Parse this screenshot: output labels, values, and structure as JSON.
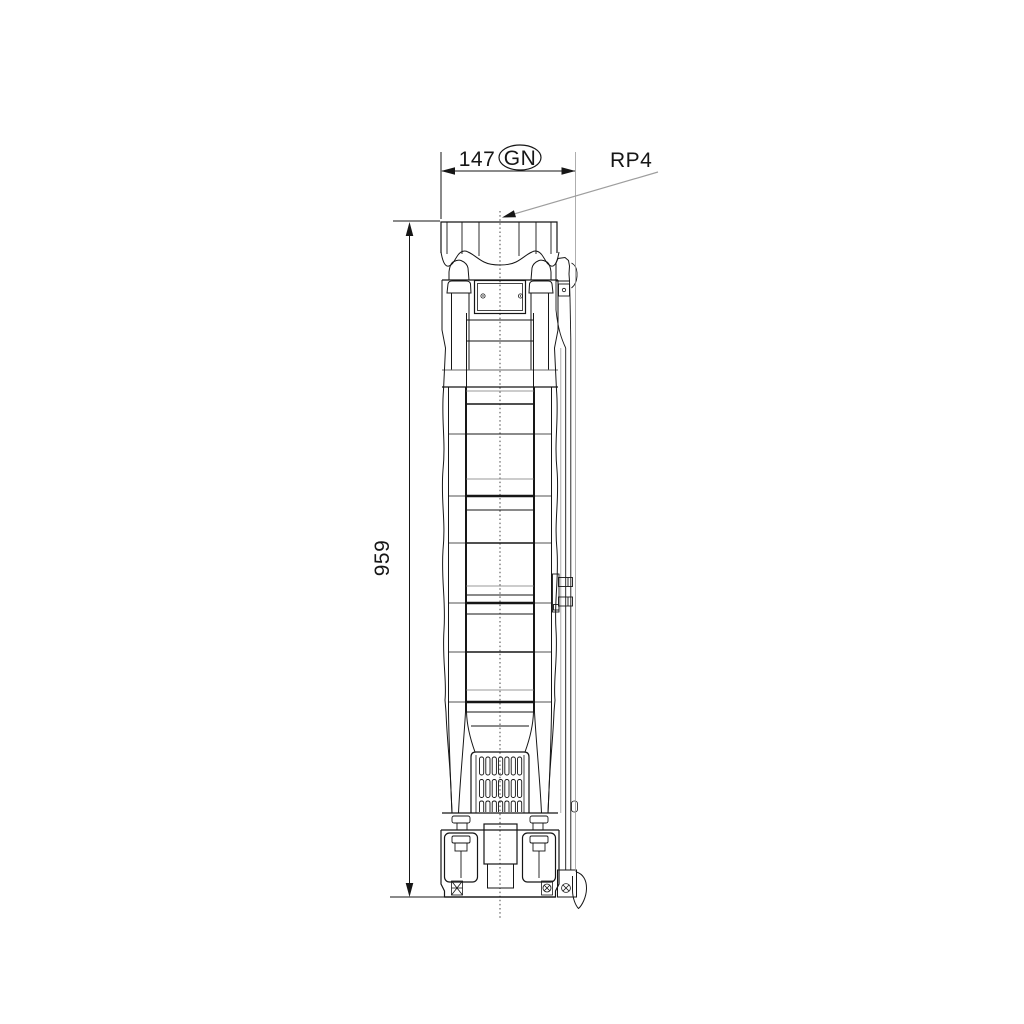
{
  "drawing": {
    "title": "Dimensional outline drawing, submersible borehole pump, side elevation",
    "labels": {
      "width_dim": "147",
      "width_badge": "GN",
      "height_dim": "959",
      "connection_label": "RP4"
    },
    "style": {
      "ink": "#161616",
      "faint": "#9a9a9a",
      "leader": "#9e9e9e",
      "band": "#6a6a6a",
      "bg": "#ffffff"
    }
  }
}
